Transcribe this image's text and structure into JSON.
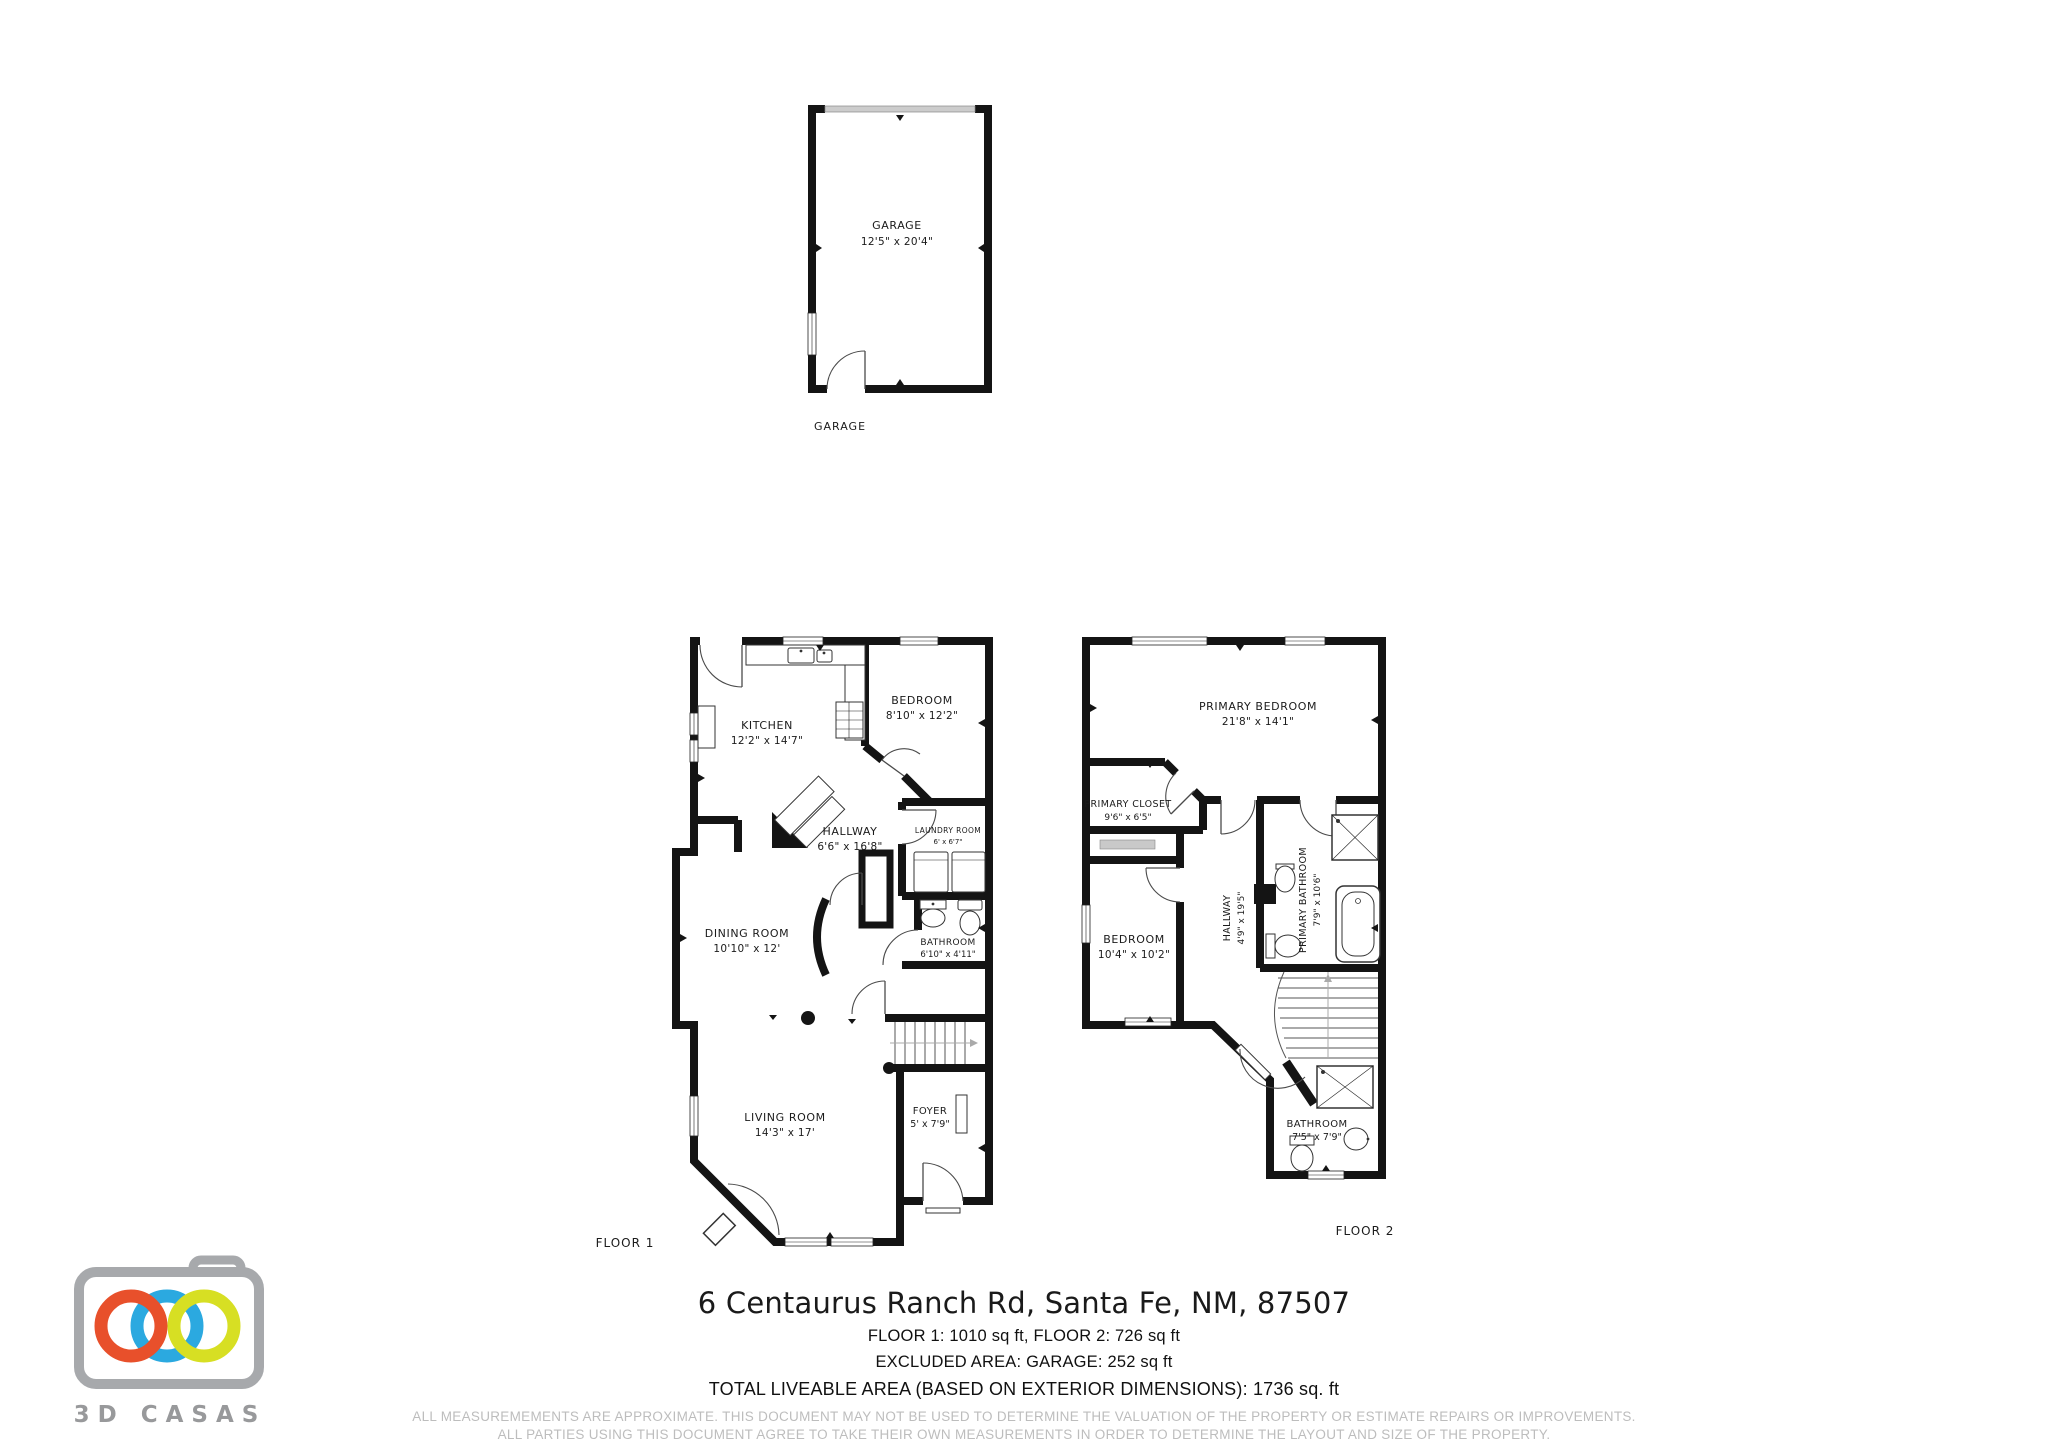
{
  "garage_plan": {
    "caption": "GARAGE",
    "room": {
      "name": "GARAGE",
      "dims": "12'5\" x 20'4\""
    }
  },
  "floor1": {
    "caption": "FLOOR 1",
    "rooms": {
      "kitchen": {
        "name": "KITCHEN",
        "dims": "12'2\" x 14'7\""
      },
      "bedroom": {
        "name": "BEDROOM",
        "dims": "8'10\" x 12'2\""
      },
      "hallway": {
        "name": "HALLWAY",
        "dims": "6'6\" x 16'8\""
      },
      "laundry": {
        "name": "LAUNDRY ROOM",
        "dims": "6' x 6'7\""
      },
      "dining": {
        "name": "DINING ROOM",
        "dims": "10'10\" x 12'"
      },
      "bathroom": {
        "name": "BATHROOM",
        "dims": "6'10\" x 4'11\""
      },
      "living": {
        "name": "LIVING ROOM",
        "dims": "14'3\" x 17'"
      },
      "foyer": {
        "name": "FOYER",
        "dims": "5' x 7'9\""
      }
    }
  },
  "floor2": {
    "caption": "FLOOR 2",
    "rooms": {
      "primary_bedroom": {
        "name": "PRIMARY BEDROOM",
        "dims": "21'8\" x 14'1\""
      },
      "primary_closet": {
        "name": "PRIMARY CLOSET",
        "dims": "9'6\" x 6'5\""
      },
      "hallway": {
        "name": "HALLWAY",
        "dims": "4'9\" x 19'5\""
      },
      "primary_bathroom": {
        "name": "PRIMARY BATHROOM",
        "dims": "7'9\" x 10'6\""
      },
      "bedroom": {
        "name": "BEDROOM",
        "dims": "10'4\" x 10'2\""
      },
      "bathroom": {
        "name": "BATHROOM",
        "dims": "7'5\" x 7'9\""
      }
    }
  },
  "footer": {
    "address": "6 Centaurus Ranch Rd, Santa Fe, NM, 87507",
    "floors_line": "FLOOR 1: 1010 sq ft, FLOOR 2: 726 sq ft",
    "excluded_line": "EXCLUDED AREA: GARAGE: 252 sq ft",
    "total_line": "TOTAL LIVEABLE AREA (BASED ON EXTERIOR DIMENSIONS): 1736 sq. ft",
    "disclaimer_line1": "ALL MEASUREMEMENTS ARE APPROXIMATE. THIS DOCUMENT MAY NOT BE USED TO DETERMINE THE VALUATION OF THE PROPERTY OR ESTIMATE REPAIRS OR IMPROVEMENTS.",
    "disclaimer_line2": "ALL PARTIES USING THIS DOCUMENT AGREE TO TAKE THEIR OWN MEASUREMENTS IN ORDER TO DETERMINE THE LAYOUT AND SIZE OF THE PROPERTY."
  },
  "logo": {
    "text": "3D CASAS",
    "body_color": "#a7a9ac",
    "ring_orange": "#e8502b",
    "ring_blue": "#2ba9e0",
    "ring_green": "#d7df23"
  }
}
